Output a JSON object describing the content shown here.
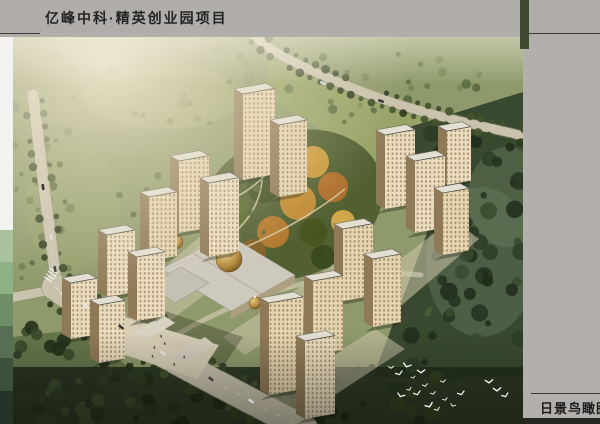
{
  "header": {
    "title": "亿峰中科·精英创业园项目"
  },
  "footer": {
    "label": "日景鸟瞰图"
  },
  "palette": {
    "board_bg": "#b1aeab",
    "accent_green": "#3f4a31",
    "rule": "#3c3c34",
    "title_color": "#242424",
    "label_color": "#1c1c1c",
    "strip_blocks": [
      "#f4f2ee",
      "#a9c29c",
      "#8fb186",
      "#6f8d67",
      "#566e51",
      "#3c513c",
      "#243428"
    ],
    "ground": "#8e9a6b",
    "road": "#c9c2ad",
    "facade_lit": "#ecdcba",
    "facade_shadow": "#8f7a58",
    "roof": "#e3dfd3",
    "forest_dark": "#2e3d26",
    "autumn_orange": "#c08a30",
    "dome_bronze": "#b58a3c",
    "bird_white": "#ffffff"
  },
  "scene": {
    "tree_regions": [
      {
        "x": 0,
        "y": 0,
        "w": 250,
        "h": 95,
        "n": 42,
        "r0": 2,
        "r1": 6,
        "o": 0.55,
        "colors": [
          "#7d8a58",
          "#68764a",
          "#8d9768",
          "#5d6b40"
        ]
      },
      {
        "x": 0,
        "y": 95,
        "w": 58,
        "h": 155,
        "n": 26,
        "r0": 2,
        "r1": 5,
        "o": 0.8,
        "colors": [
          "#5d6c41",
          "#4a5834",
          "#6b7a4a"
        ]
      },
      {
        "x": 0,
        "y": 282,
        "w": 135,
        "h": 105,
        "n": 40,
        "r0": 3,
        "r1": 8,
        "o": 0.9,
        "colors": [
          "#2f3d22",
          "#243019",
          "#3b4a2a"
        ]
      },
      {
        "x": 120,
        "y": 330,
        "w": 310,
        "h": 57,
        "n": 45,
        "r0": 3,
        "r1": 8,
        "o": 0.9,
        "colors": [
          "#27331d",
          "#1d2815",
          "#32411f"
        ]
      },
      {
        "x": 398,
        "y": 88,
        "w": 112,
        "h": 250,
        "n": 60,
        "r0": 3,
        "r1": 9,
        "o": 0.85,
        "colors": [
          "#2e3d26",
          "#243220",
          "#3a4a2e",
          "#1f2c1a"
        ]
      },
      {
        "x": 255,
        "y": 16,
        "w": 215,
        "h": 72,
        "n": 26,
        "r0": 2,
        "r1": 5,
        "o": 0.75,
        "colors": [
          "#5f7040",
          "#72824e",
          "#4f6038"
        ]
      },
      {
        "x": 95,
        "y": 120,
        "w": 330,
        "h": 200,
        "n": 28,
        "r0": 2,
        "r1": 4,
        "o": 0.8,
        "colors": [
          "#4f5f33",
          "#5d6b3a"
        ]
      }
    ],
    "roads": [
      {
        "d": "M240,-4 C252,14 300,36 358,58 C418,80 468,88 514,100",
        "w": 9,
        "side": 7,
        "step": 11
      },
      {
        "d": "M20,58 C27,120 36,190 44,250",
        "w": 11,
        "side": 8.5,
        "step": 13
      },
      {
        "d": "M44,252 L-4,261",
        "w": 9,
        "side": 0,
        "step": 0
      },
      {
        "d": "M42,250 C110,298 180,334 292,392",
        "w": 26,
        "side": 17,
        "step": 12
      }
    ],
    "inner_paths": [
      "M120,262 C190,208 240,175 272,152",
      "M160,300 C240,252 330,230 408,238",
      "M300,130 C330,160 350,200 352,246"
    ],
    "paving": [
      "150,232 252,142 292,162 186,254",
      "78,302 172,232 202,250 106,322",
      "348,252 440,182 466,202 382,274",
      "248,362 362,292 392,312 282,384",
      "210,300 330,222 352,238 232,318"
    ],
    "garden": {
      "base": {
        "cx": 278,
        "cy": 168,
        "rx": 95,
        "ry": 72,
        "rot": -22,
        "fill": "#4e5c2e"
      },
      "blobs": [
        {
          "x": 240,
          "y": 120,
          "r": 18,
          "c": "#8f9a42"
        },
        {
          "x": 270,
          "y": 105,
          "r": 14,
          "c": "#c08a30"
        },
        {
          "x": 300,
          "y": 125,
          "r": 16,
          "c": "#d2a03c"
        },
        {
          "x": 320,
          "y": 150,
          "r": 15,
          "c": "#b5702a"
        },
        {
          "x": 250,
          "y": 150,
          "r": 16,
          "c": "#405023"
        },
        {
          "x": 285,
          "y": 165,
          "r": 18,
          "c": "#c98f35"
        },
        {
          "x": 225,
          "y": 175,
          "r": 14,
          "c": "#5a6a2e"
        },
        {
          "x": 260,
          "y": 195,
          "r": 16,
          "c": "#b87b2e"
        },
        {
          "x": 300,
          "y": 195,
          "r": 14,
          "c": "#46561f"
        },
        {
          "x": 330,
          "y": 185,
          "r": 12,
          "c": "#d9ad4a"
        },
        {
          "x": 210,
          "y": 150,
          "r": 12,
          "c": "#97a149"
        },
        {
          "x": 240,
          "y": 215,
          "r": 13,
          "c": "#8a5f26"
        },
        {
          "x": 310,
          "y": 220,
          "r": 12,
          "c": "#3a4a1e"
        },
        {
          "x": 350,
          "y": 205,
          "r": 10,
          "c": "#c49038"
        }
      ],
      "paths": [
        "M214,202 C240,182 256,152 246,120",
        "M228,212 C266,196 302,176 332,152",
        "M200,170 C230,160 258,140 270,112"
      ]
    },
    "domes": [
      {
        "cx": 216,
        "cy": 222,
        "r": 13
      },
      {
        "cx": 163,
        "cy": 205,
        "r": 7
      },
      {
        "cx": 242,
        "cy": 266,
        "r": 6
      }
    ],
    "towers": [
      {
        "x": 230,
        "y": 143,
        "w": 32,
        "h": 86
      },
      {
        "x": 266,
        "y": 160,
        "w": 28,
        "h": 72
      },
      {
        "x": 166,
        "y": 196,
        "w": 30,
        "h": 72
      },
      {
        "x": 196,
        "y": 220,
        "w": 30,
        "h": 74
      },
      {
        "x": 136,
        "y": 224,
        "w": 28,
        "h": 64
      },
      {
        "x": 94,
        "y": 260,
        "w": 28,
        "h": 62
      },
      {
        "x": 124,
        "y": 284,
        "w": 28,
        "h": 64
      },
      {
        "x": 58,
        "y": 302,
        "w": 26,
        "h": 56
      },
      {
        "x": 86,
        "y": 326,
        "w": 26,
        "h": 58
      },
      {
        "x": 372,
        "y": 172,
        "w": 30,
        "h": 74
      },
      {
        "x": 402,
        "y": 196,
        "w": 30,
        "h": 72
      },
      {
        "x": 430,
        "y": 218,
        "w": 26,
        "h": 62
      },
      {
        "x": 434,
        "y": 148,
        "w": 24,
        "h": 54
      },
      {
        "x": 330,
        "y": 264,
        "w": 30,
        "h": 72
      },
      {
        "x": 360,
        "y": 290,
        "w": 28,
        "h": 68
      },
      {
        "x": 300,
        "y": 318,
        "w": 30,
        "h": 74
      },
      {
        "x": 256,
        "y": 358,
        "w": 34,
        "h": 92
      },
      {
        "x": 292,
        "y": 382,
        "w": 30,
        "h": 78
      }
    ],
    "cars": [
      {
        "x": 72,
        "y": 268,
        "a": 38,
        "c": "#e8e6e0"
      },
      {
        "x": 108,
        "y": 290,
        "a": 38,
        "c": "#2e2e2e"
      },
      {
        "x": 150,
        "y": 316,
        "a": 38,
        "c": "#d8d8d4"
      },
      {
        "x": 198,
        "y": 342,
        "a": 38,
        "c": "#3a3a3a"
      },
      {
        "x": 238,
        "y": 364,
        "a": 38,
        "c": "#cfcfcb"
      },
      {
        "x": 30,
        "y": 150,
        "a": 82,
        "c": "#2e2e2e"
      },
      {
        "x": 38,
        "y": 200,
        "a": 82,
        "c": "#e2e2de"
      },
      {
        "x": 42,
        "y": 232,
        "a": 82,
        "c": "#444444"
      },
      {
        "x": 310,
        "y": 46,
        "a": 20,
        "c": "#dddddd"
      },
      {
        "x": 368,
        "y": 64,
        "a": 20,
        "c": "#333333"
      }
    ],
    "birds": [
      [
        378,
        330
      ],
      [
        386,
        336
      ],
      [
        394,
        328
      ],
      [
        400,
        340
      ],
      [
        408,
        334
      ],
      [
        396,
        352
      ],
      [
        388,
        358
      ],
      [
        404,
        356
      ],
      [
        412,
        348
      ],
      [
        420,
        356
      ],
      [
        416,
        368
      ],
      [
        424,
        372
      ],
      [
        432,
        362
      ],
      [
        440,
        368
      ],
      [
        430,
        344
      ],
      [
        448,
        356
      ],
      [
        484,
        352
      ],
      [
        492,
        358
      ],
      [
        476,
        344
      ]
    ]
  }
}
